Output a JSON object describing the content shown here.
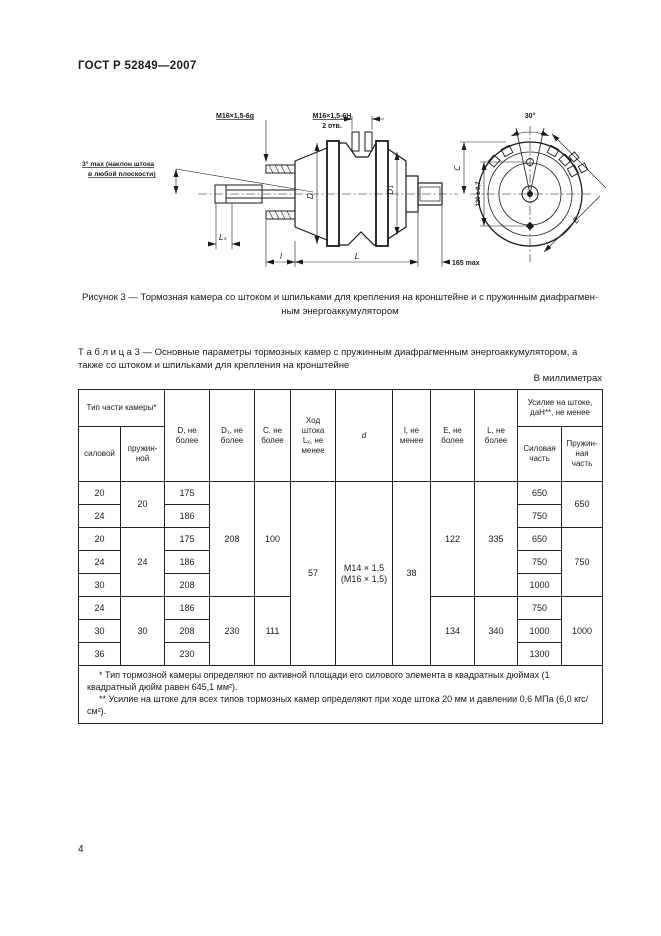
{
  "page": {
    "doc_number": "ГОСТ Р 52849—2007",
    "page_number": "4"
  },
  "figure": {
    "caption": "Рисунок 3 — Тормозная камера со штоком и шпильками для крепления на кронштейне и с пружинным диафрагмен-\nным энергоаккумулятором",
    "labels": {
      "thread_rod": "М16×1,5-6g",
      "thread_holes": "М16×1,5-6Н",
      "holes_count": "2 отв.",
      "tilt_note_1": "3° max (наклон штока",
      "tilt_note_2": "в любой плоскости)",
      "dim_D": "D",
      "dim_D1": "D₁",
      "dim_Lx": "Lₓ",
      "dim_l": "l",
      "dim_L": "L",
      "dim_165": "165 max",
      "dim_C": "С",
      "angle_30": "30°",
      "dim_120": "120 ± 0,7",
      "dim_E": "Е"
    }
  },
  "table": {
    "title": "Т а б л и ц а  3 — Основные параметры тормозных камер с пружинным диафрагменным энергоаккумулятором, а\nтакже со штоком и шпильками для крепления на кронштейне",
    "units": "В миллиметрах",
    "head": {
      "type": "Тип части камеры*",
      "silovoy": "силовой",
      "pruzhinnoy": "пружин-\nной",
      "D": "D, не\nболее",
      "D1": "D₁, не\nболее",
      "C": "С, не\nболее",
      "hod": "Ход\nштока\nLₓ, не\nменее",
      "d": "d",
      "l": "l, не\nменее",
      "E": "Е, не\nболее",
      "L": "L, не\nболее",
      "usilie": "Усилие на штоке,\nдаН**, не менее",
      "sil_chast": "Силовая\nчасть",
      "pruzh_chast": "Пружин-\nная\nчасть"
    },
    "rows": [
      [
        "20",
        "20",
        "175",
        "208",
        "100",
        "57",
        "М14 × 1,5",
        "(М16 × 1,5)",
        "38",
        "122",
        "335",
        "650",
        "650"
      ],
      [
        "24",
        "186",
        "750"
      ],
      [
        "20",
        "24",
        "175",
        "650",
        "750"
      ],
      [
        "24",
        "186",
        "750"
      ],
      [
        "30",
        "208",
        "1000"
      ],
      [
        "24",
        "30",
        "186",
        "230",
        "111",
        "134",
        "340",
        "750",
        "1000"
      ],
      [
        "30",
        "208",
        "1000"
      ],
      [
        "36",
        "230",
        "1300"
      ]
    ],
    "footnotes": [
      "* Тип тормозной камеры определяют по активной площади его силового элемента в квадратных дюймах (1 квадратный дюйм равен 645,1 мм²).",
      "** Усилие на штоке для всех типов тормозных камер определяют при ходе штока 20 мм и давлении 0,6 МПа (6,0 кгс/см²)."
    ]
  }
}
